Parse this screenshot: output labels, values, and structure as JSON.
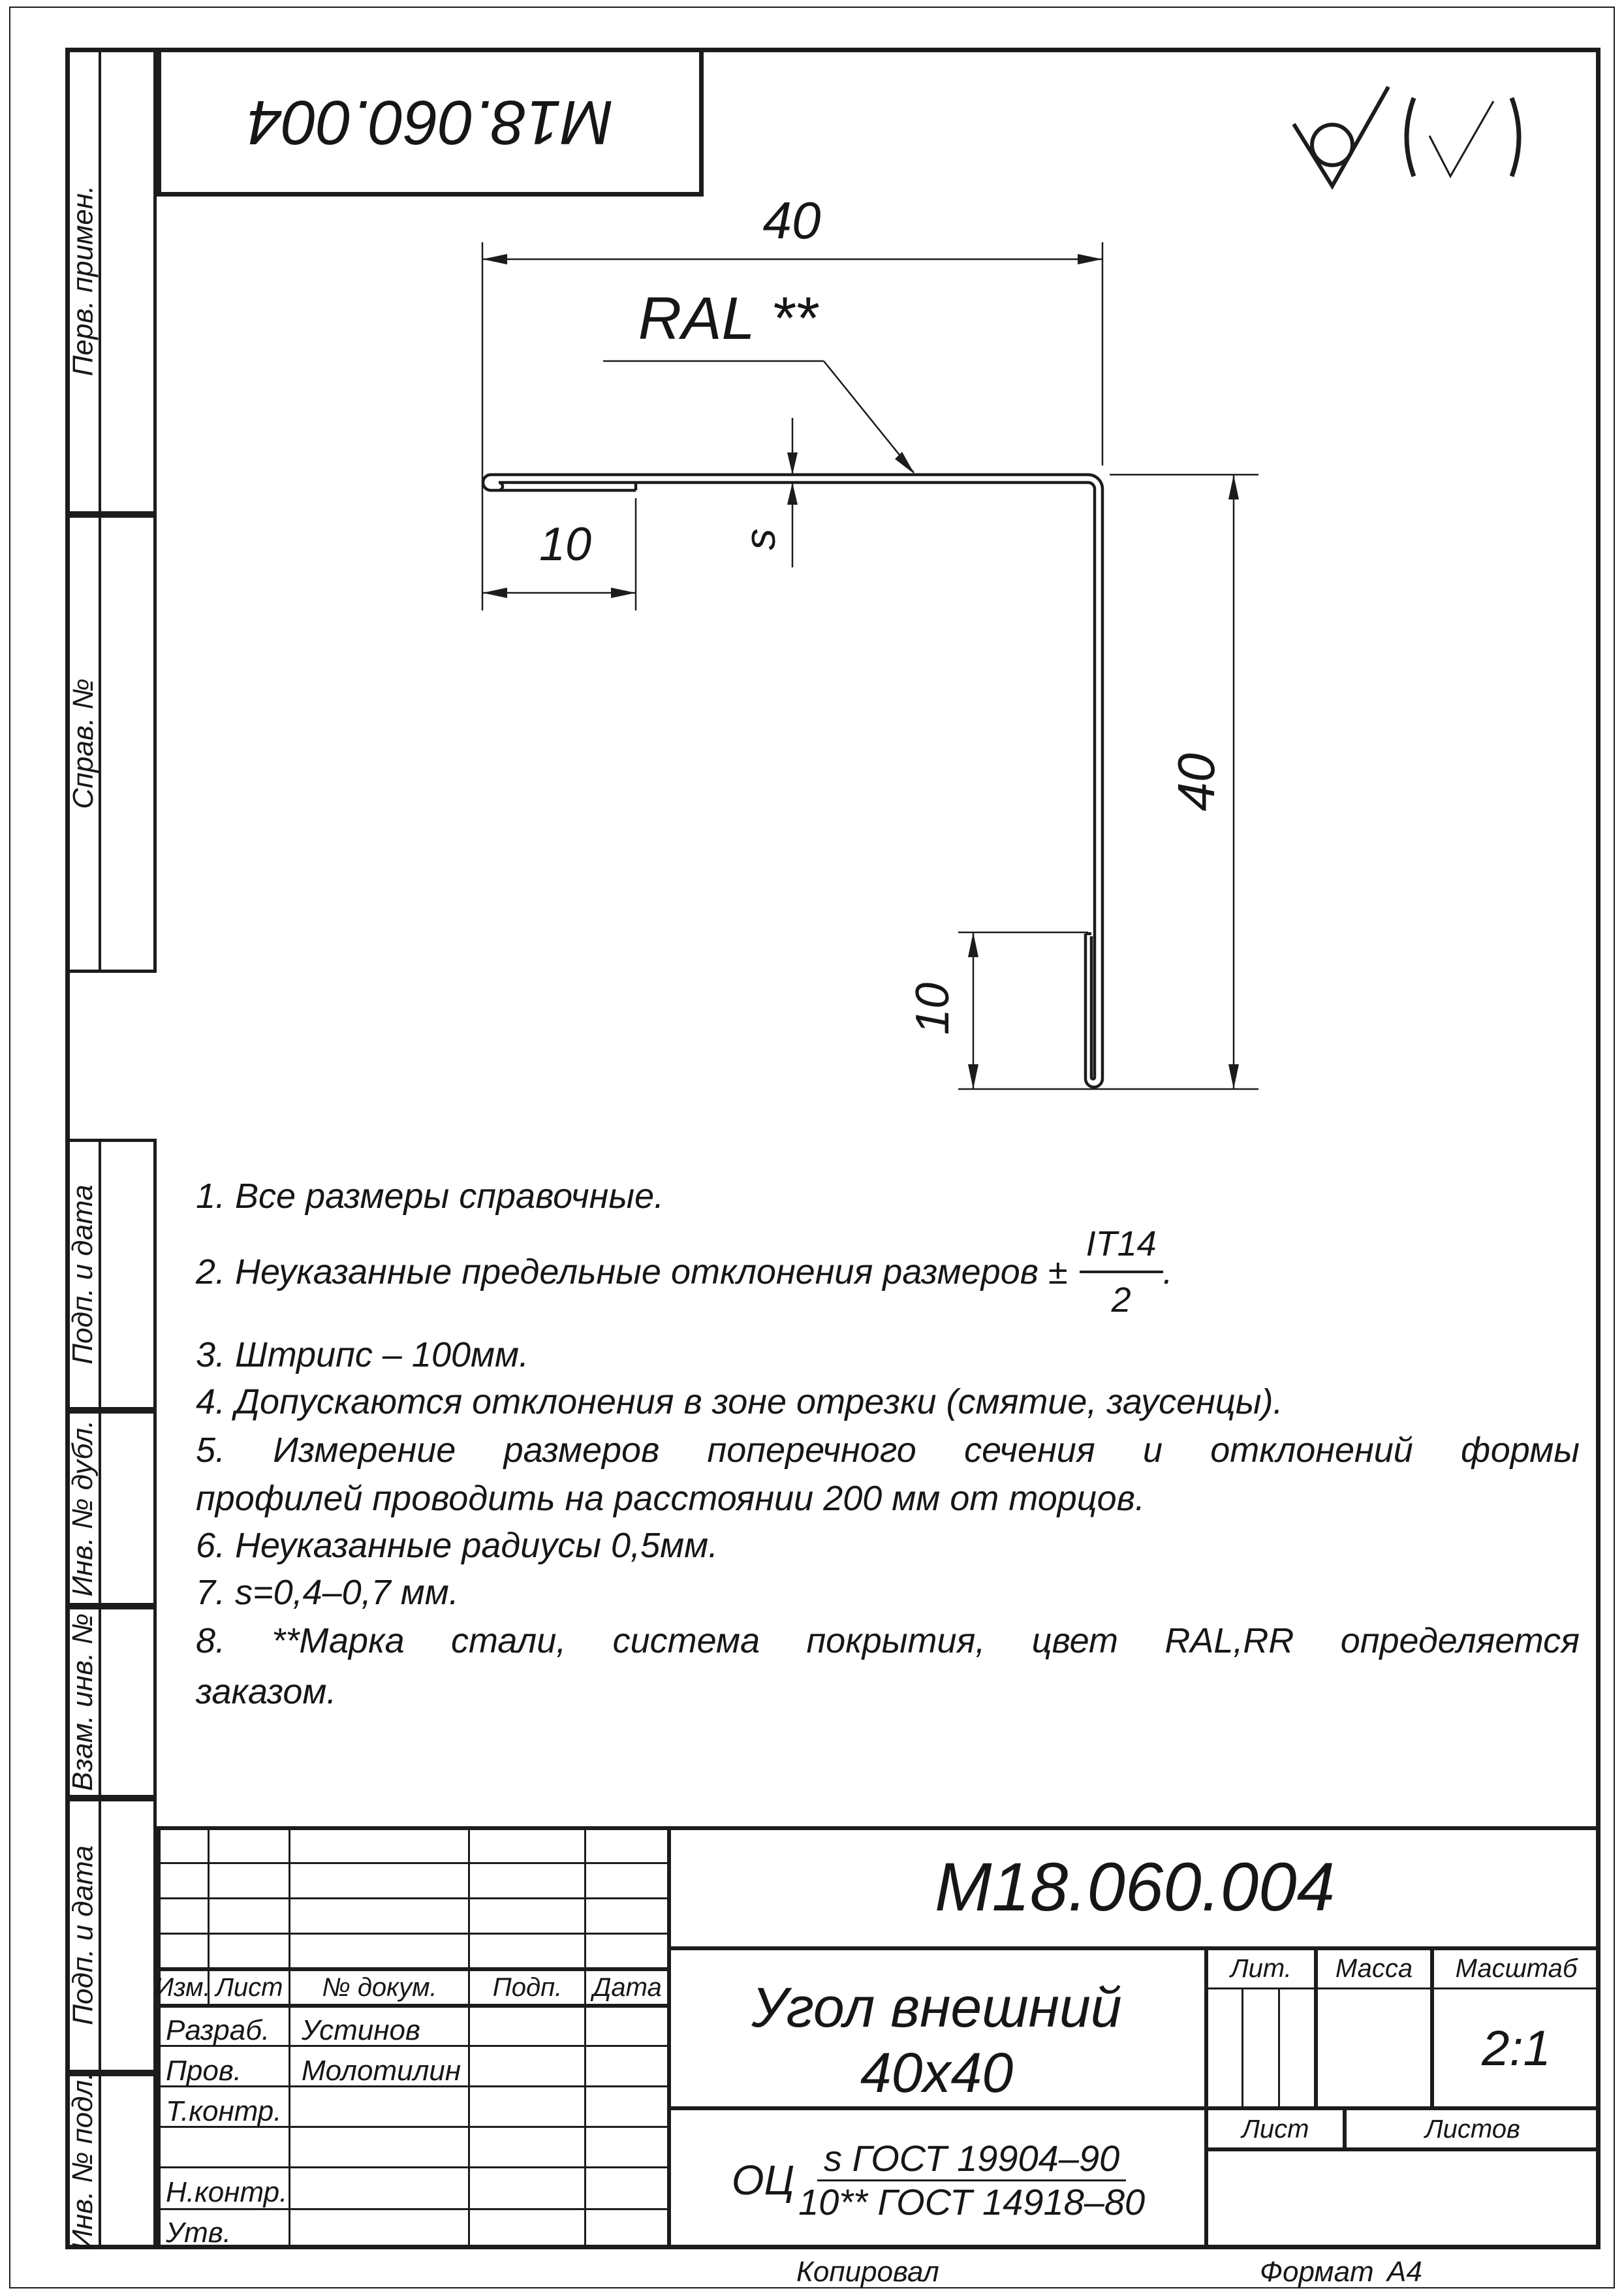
{
  "stamp_top": {
    "number": "М18.060.004"
  },
  "sidebar": {
    "labels": [
      "Перв. примен.",
      "Справ. №",
      "Подп. и дата",
      "Инв. № дубл.",
      "Взам. инв. №",
      "Подп. и дата",
      "Инв. № подл."
    ]
  },
  "drawing": {
    "dim_top_leg": "40",
    "dim_top_hem": "10",
    "dim_right_leg": "40",
    "dim_bottom_hem": "10",
    "thickness_label": "s",
    "coating_label": "RAL **",
    "roughness_icon": "check-circle-roughness",
    "roughness_others_icon": "bracketed-check"
  },
  "notes": {
    "n1": "1.  Все размеры справочные.",
    "n2_pre": "2.  Неуказанные предельные отклонения размеров ±",
    "n2_num": "IT14",
    "n2_den": "2",
    "n2_tail": ".",
    "n3": "3.  Штрипс – 100мм.",
    "n4": "4.  Допускаются отклонения в зоне отрезки (смятие, заусенцы).",
    "n5_l1": "5.  Измерение размеров поперечного сечения и отклонений формы",
    "n5_l2": "профилей проводить на расстоянии 200 мм от торцов.",
    "n6": "6.  Неуказанные радиусы 0,5мм.",
    "n7": "7.  s=0,4–0,7 мм.",
    "n8_l1": "8.  **Марка стали, система покрытия, цвет RAL,RR определяется",
    "n8_l2": "заказом."
  },
  "title_block": {
    "designation": "М18.060.004",
    "name_line1": "Угол внешний",
    "name_line2": "40x40",
    "col_headers": {
      "izm": "Изм.",
      "list": "Лист",
      "doc": "№ докум.",
      "podp": "Подп.",
      "data": "Дата"
    },
    "cells": {
      "lit": "Лит.",
      "massa": "Масса",
      "masshtab": "Масштаб",
      "list": "Лист",
      "listov": "Листов"
    },
    "scale": "2:1",
    "staff": [
      {
        "label": "Разраб.",
        "name": "Устинов"
      },
      {
        "label": "Пров.",
        "name": "Молотилин"
      },
      {
        "label": "Т.контр.",
        "name": ""
      },
      {
        "label": "Н.контр.",
        "name": ""
      },
      {
        "label": "Утв.",
        "name": ""
      }
    ],
    "material": {
      "prefix": "ОЦ",
      "num": "s ГОСТ 19904–90",
      "den": "10** ГОСТ 14918–80"
    }
  },
  "footer": {
    "copied": "Копировал",
    "format_label": "Формат",
    "format_value": "А4"
  }
}
